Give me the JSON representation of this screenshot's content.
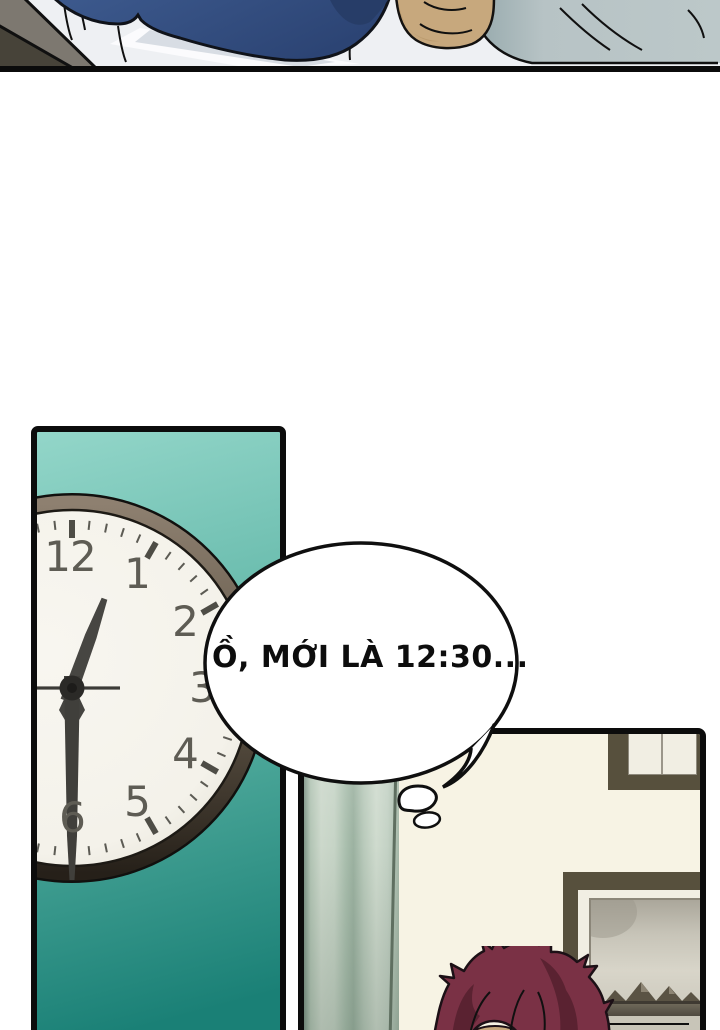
{
  "bubble": {
    "text": "Ồ, MỚI LÀ 12:30..."
  },
  "clock": {
    "time_shown": "12:30",
    "numerals": [
      "12",
      "1",
      "2",
      "3",
      "4",
      "5",
      "6"
    ]
  },
  "colors": {
    "panel-border": "#0c0c0c",
    "teal-top": "#93d6c9",
    "teal-bottom": "#1a8076",
    "rim-light": "#8e8070",
    "rim-dark": "#262019",
    "face": "#f6f4ee",
    "numeral": "#5e5c54",
    "hand": "#424140",
    "wall": "#f7f3e4",
    "frame": "#57503d",
    "mat": "#f1eee3",
    "curtain-mid": "#c2d1c3",
    "hair-main": "#7a3145",
    "hair-dark": "#55202e",
    "blanket": "#355182",
    "pillow": "#b7c3c5",
    "sheet": "#eef0f3",
    "skin": "#c7a87d",
    "nightstand-light": "#7d7870",
    "nightstand-dark": "#474339",
    "picture-sky": "#d6d3c8",
    "picture-water": "#5f5a4e"
  }
}
